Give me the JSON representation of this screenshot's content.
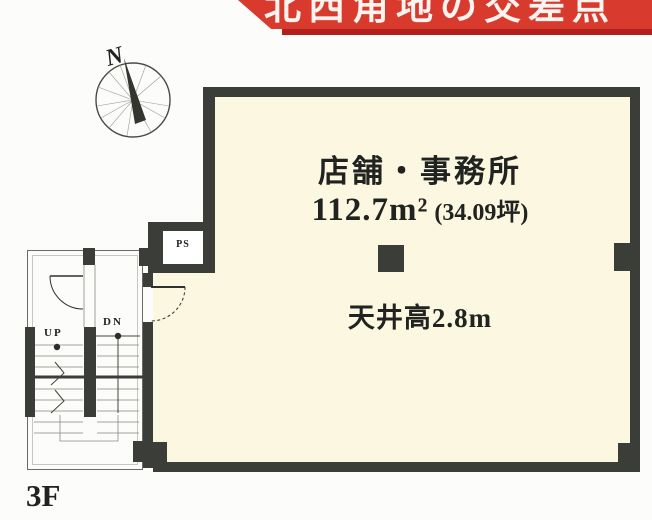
{
  "banner": {
    "text": "北西角地の交差点",
    "bg_color": "#d93a2e",
    "shadow_color": "#b2201b",
    "text_color": "#fdf3ef"
  },
  "compass": {
    "north_label": "N"
  },
  "room": {
    "name": "店舗・事務所",
    "area_sqm": "112.7m²",
    "area_tsubo": "(34.09坪)",
    "ceiling": "天井高2.8m"
  },
  "labels": {
    "pipe_shaft": "PS",
    "stair_up": "UP",
    "stair_down": "DN",
    "floor": "3F"
  },
  "colors": {
    "wall": "#3a3d38",
    "room_fill": "#fcf7e1",
    "outline": "#6b6b66",
    "background": "#fcfcfa",
    "text": "#20231f"
  }
}
